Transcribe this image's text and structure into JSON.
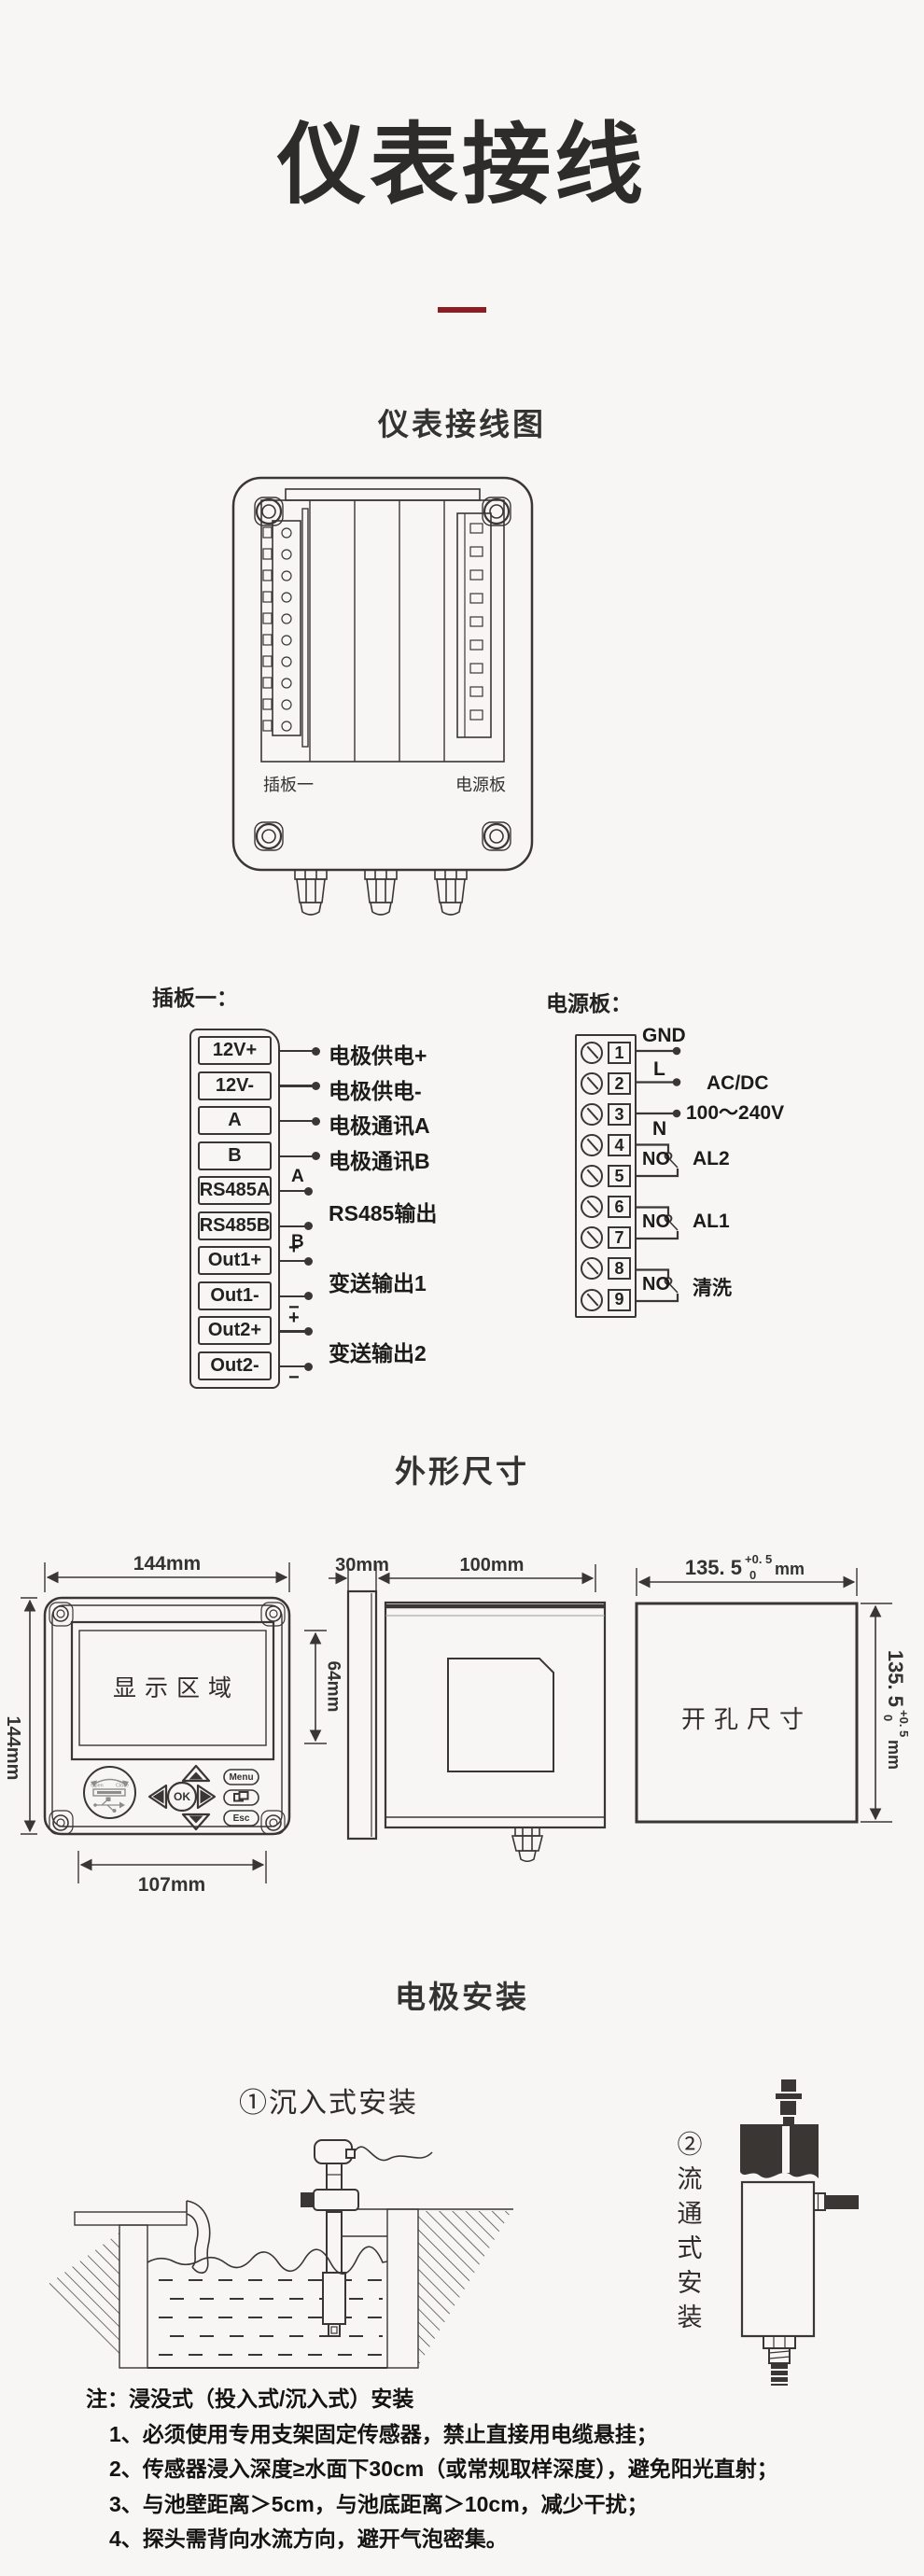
{
  "page": {
    "bg": "#f7f6f4",
    "ink": "#3a3633",
    "accent": "#8e1d22"
  },
  "header": {
    "title": "仪表接线"
  },
  "sections": {
    "wiring": "仪表接线图",
    "dims": "外形尺寸",
    "install": "电极安装"
  },
  "wiring_box": {
    "slot1": "插板一",
    "power": "电源板"
  },
  "plugboard": {
    "heading": "插板一：",
    "terminals": [
      "12V+",
      "12V-",
      "A",
      "B",
      "RS485A",
      "RS485B",
      "Out1+",
      "Out1-",
      "Out2+",
      "Out2-"
    ],
    "descs": [
      "电极供电+",
      "电极供电-",
      "电极通讯A",
      "电极通讯B"
    ],
    "groups": [
      "RS485输出",
      "变送输出1",
      "变送输出2"
    ],
    "marks": {
      "a": "A",
      "b": "B",
      "plus": "+",
      "minus": "−"
    }
  },
  "powerboard": {
    "heading": "电源板：",
    "numbers": [
      "1",
      "2",
      "3",
      "4",
      "5",
      "6",
      "7",
      "8",
      "9"
    ],
    "gnd": "GND",
    "live": "L",
    "neutral": "N",
    "supply": "AC/DC",
    "supply_range": "100～240V",
    "no": "NO",
    "relay_al2": "AL2",
    "relay_al1": "AL1",
    "relay_wash": "清洗"
  },
  "dims": {
    "front_width": "144mm",
    "front_height": "144mm",
    "panel_width": "107mm",
    "display": "显示区域",
    "display_height": "64mm",
    "knob_open": "Open",
    "knob_close": "Close",
    "ok": "OK",
    "menu": "Menu",
    "esc": "Esc",
    "bezel_depth": "30mm",
    "body_depth": "100mm",
    "cutout": "开孔尺寸",
    "cut_main": "135. 5",
    "cut_sup": "+0. 5",
    "cut_sub": "0",
    "cut_unit": "mm"
  },
  "install": {
    "immersion": "①沉入式安装",
    "flow": "②流通式安装",
    "note_title": "注：浸没式（投入式/沉入式）安装",
    "notes": [
      "1、必须使用专用支架固定传感器，禁止直接用电缆悬挂；",
      "2、传感器浸入深度≥水面下30cm（或常规取样深度），避免阳光直射；",
      "3、与池壁距离＞5cm，与池底距离＞10cm，减少干扰；",
      "4、探头需背向水流方向，避开气泡密集。"
    ]
  }
}
